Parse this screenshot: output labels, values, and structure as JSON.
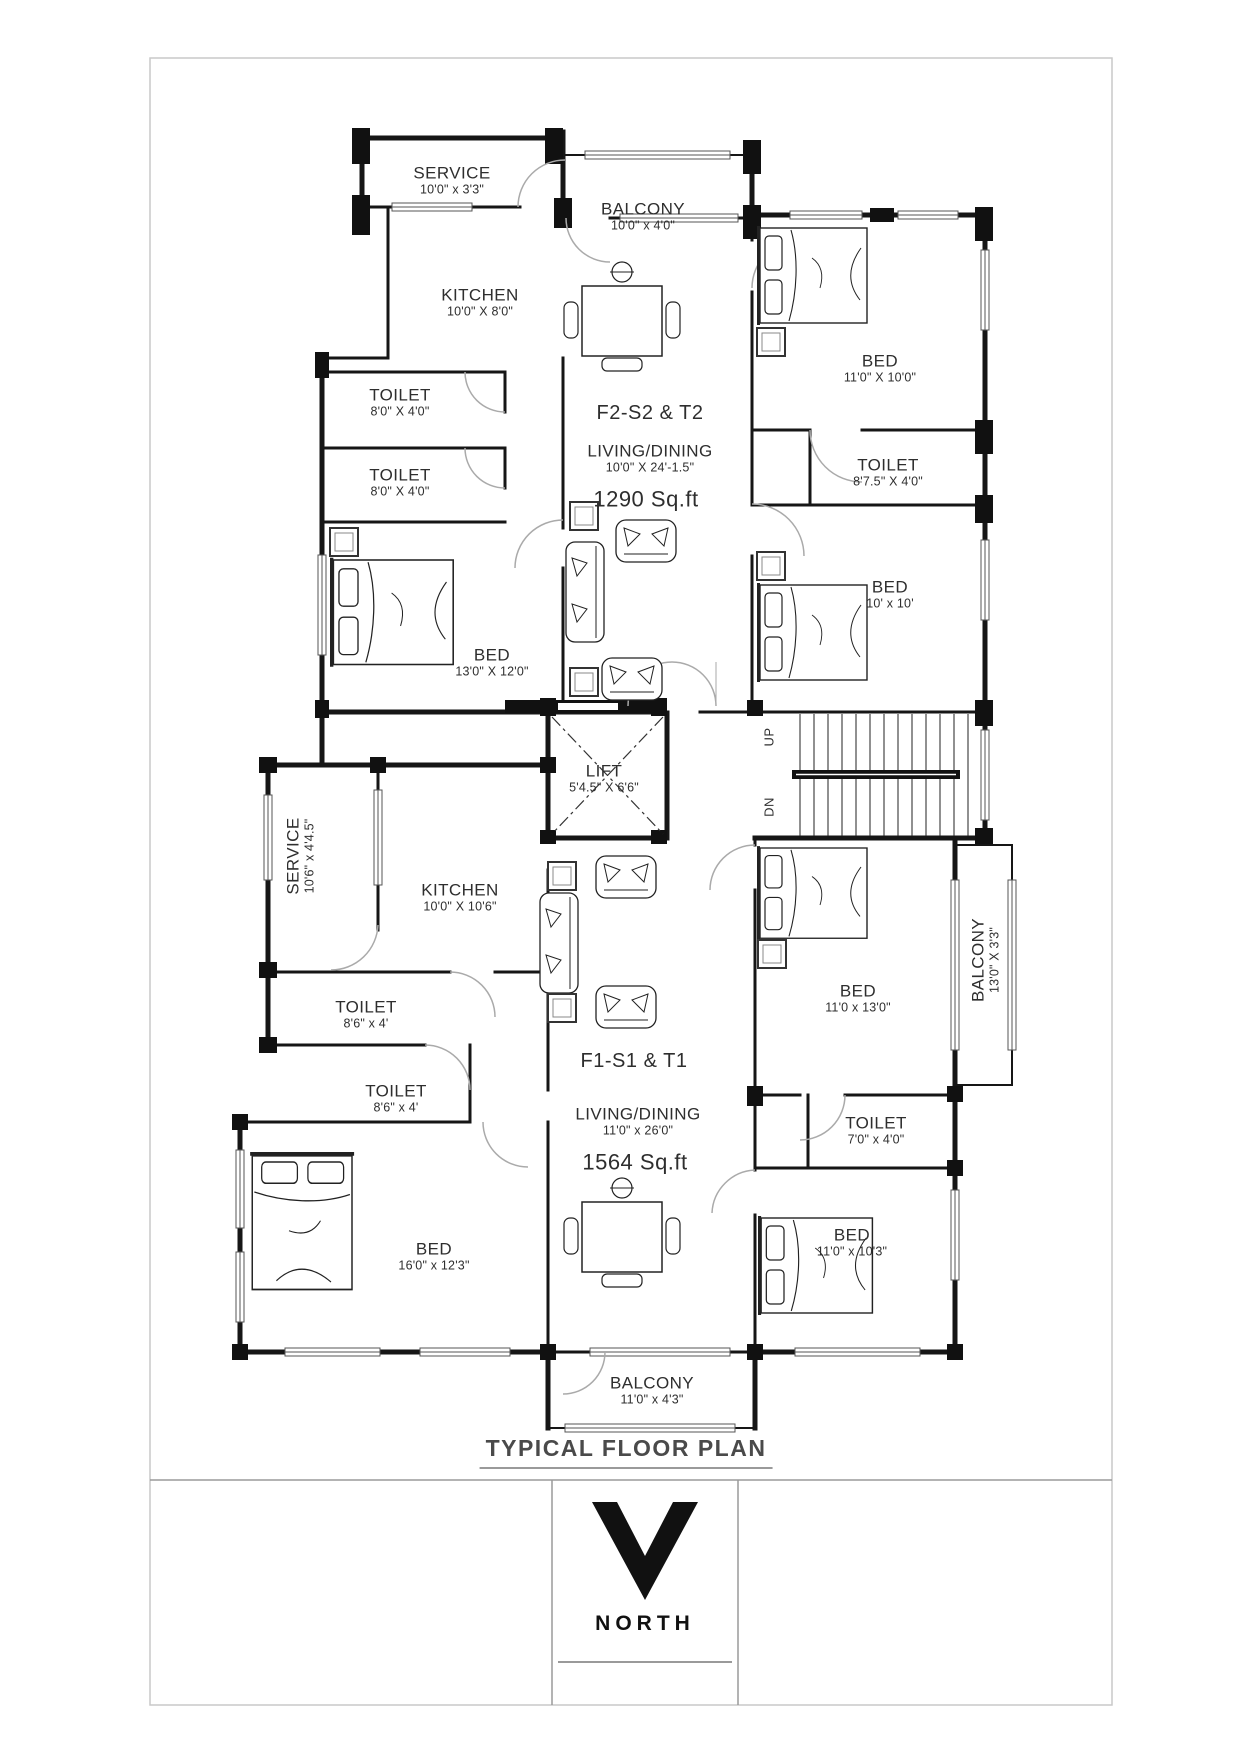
{
  "page": {
    "title": "TYPICAL FLOOR PLAN",
    "north_label": "NORTH"
  },
  "colors": {
    "wall_ink": "#161616",
    "door_gray": "#aaaaaa",
    "title_gray": "#4a4a4a"
  },
  "units": {
    "f2": {
      "name": "F2-S2 & T2",
      "living_label": "LIVING/DINING",
      "living_dim": "10'0\" X 24'-1.5\"",
      "area": "1290  Sq.ft"
    },
    "f1": {
      "name": "F1-S1 & T1",
      "living_label": "LIVING/DINING",
      "living_dim": "11'0\" x 26'0\"",
      "area": "1564  Sq.ft"
    }
  },
  "rooms": {
    "service_top": {
      "name": "SERVICE",
      "dim": "10'0\" x 3'3\""
    },
    "balcony_top": {
      "name": "BALCONY",
      "dim": "10'0\" x 4'0\""
    },
    "kitchen_top": {
      "name": "KITCHEN",
      "dim": "10'0\" X 8'0\""
    },
    "toilet_top_1": {
      "name": "TOILET",
      "dim": "8'0\" X 4'0\""
    },
    "toilet_top_2": {
      "name": "TOILET",
      "dim": "8'0\" X 4'0\""
    },
    "bed_top_right": {
      "name": "BED",
      "dim": "11'0\" X 10'0\""
    },
    "toilet_top_right": {
      "name": "TOILET",
      "dim": "8'7.5\" X 4'0\""
    },
    "bed_mid_right": {
      "name": "BED",
      "dim": "10' x 10'"
    },
    "bed_mid_left": {
      "name": "BED",
      "dim": "13'0\" X 12'0\""
    },
    "lift": {
      "name": "LIFT",
      "dim": "5'4.5\" X 6'6\""
    },
    "stairs": {
      "up": "UP",
      "dn": "DN"
    },
    "service_bottom": {
      "name": "SERVICE",
      "dim": "10'6\" x 4'4.5\""
    },
    "kitchen_bottom": {
      "name": "KITCHEN",
      "dim": "10'0\" X 10'6\""
    },
    "toilet_bot_1": {
      "name": "TOILET",
      "dim": "8'6\" x 4'"
    },
    "toilet_bot_2": {
      "name": "TOILET",
      "dim": "8'6\" x 4'"
    },
    "bed_right_upper": {
      "name": "BED",
      "dim": "11'0 x 13'0\""
    },
    "balcony_right": {
      "name": "BALCONY",
      "dim": "13'0\" X 3'3\""
    },
    "toilet_bot_right": {
      "name": "TOILET",
      "dim": "7'0\" x 4'0\""
    },
    "bed_bot_left": {
      "name": "BED",
      "dim": "16'0\" x 12'3\""
    },
    "bed_bot_right": {
      "name": "BED",
      "dim": "11'0\" x 10'3\""
    },
    "balcony_bottom": {
      "name": "BALCONY",
      "dim": "11'0\" x 4'3\""
    }
  }
}
